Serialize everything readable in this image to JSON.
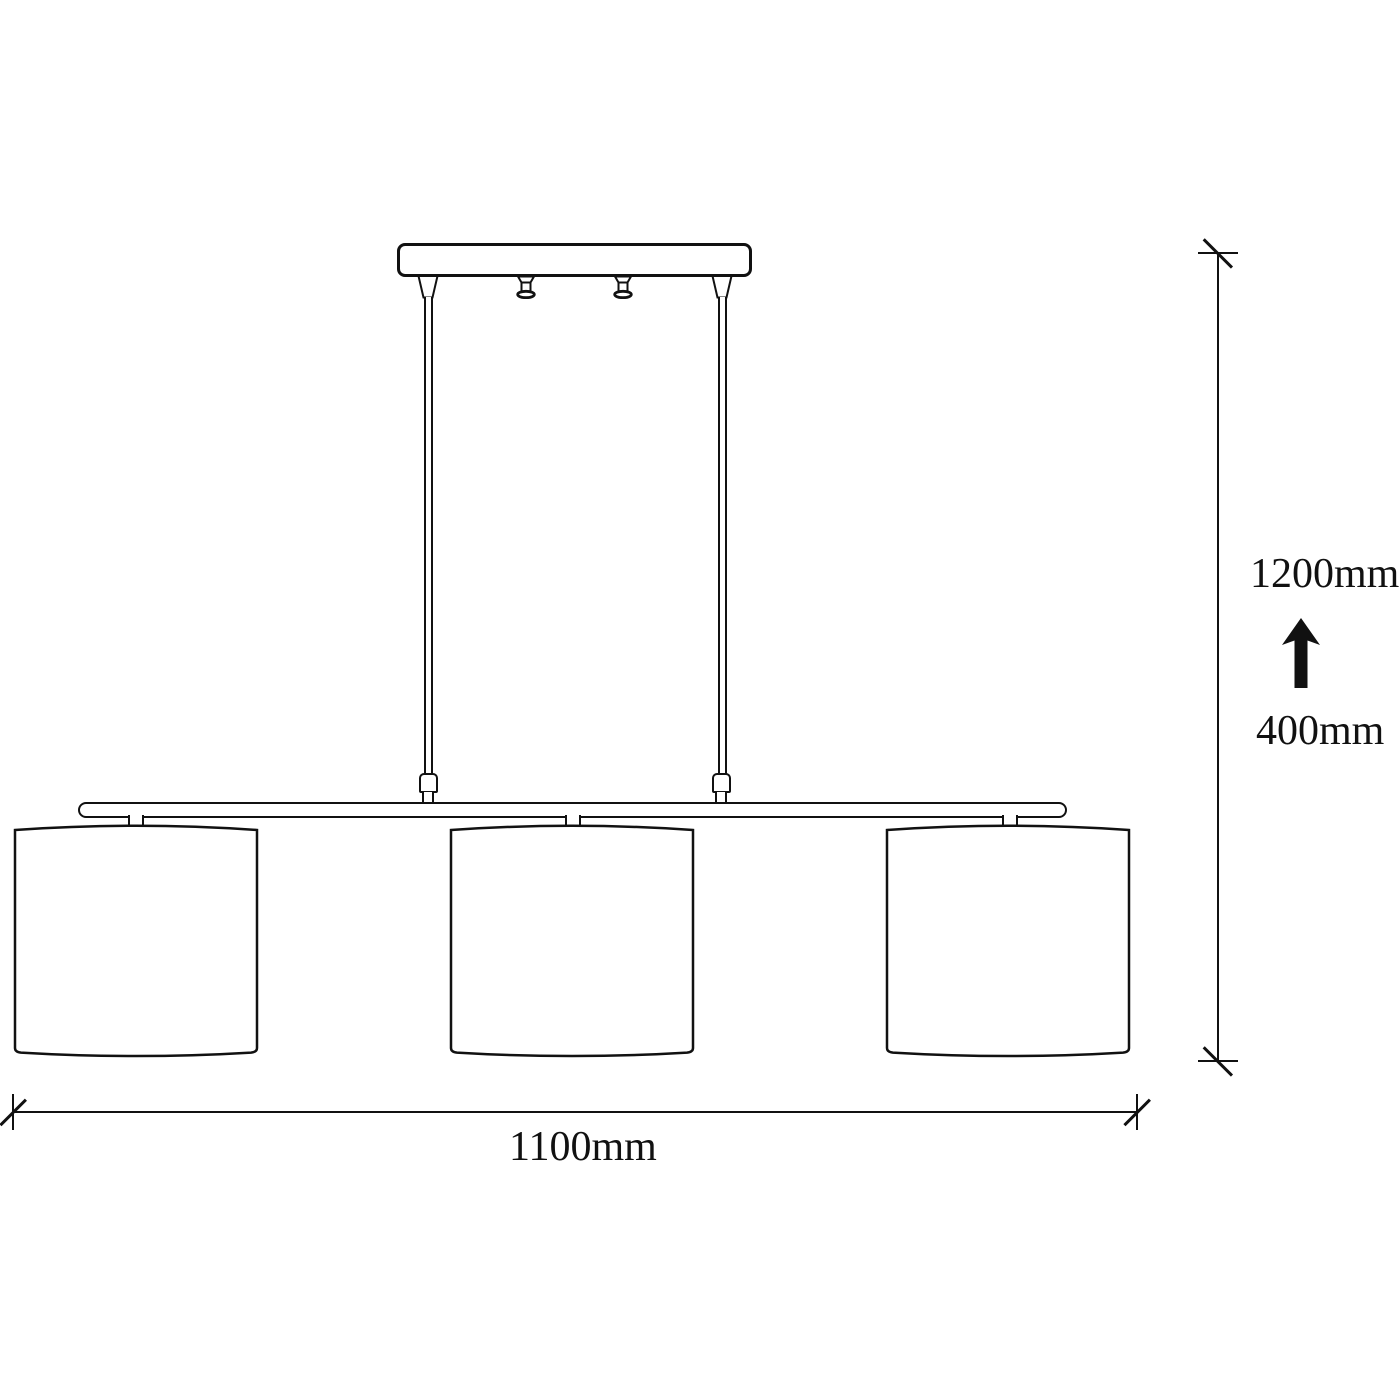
{
  "diagram": {
    "title": "pendant-lamp-dimension-drawing",
    "shade_count": 3,
    "colors": {
      "line": "#111111",
      "background": "#ffffff"
    },
    "dimensions": {
      "drop_height_max": "1200mm",
      "drop_height_min": "400mm",
      "overall_width": "1100mm"
    }
  }
}
